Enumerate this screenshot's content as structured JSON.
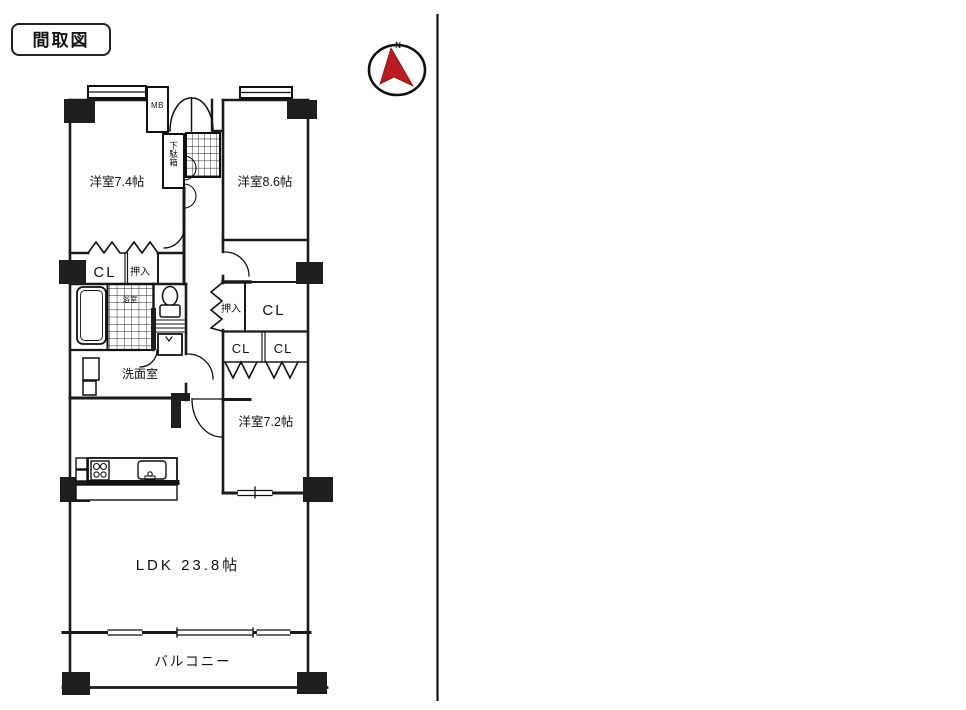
{
  "header": {
    "title": "間取図"
  },
  "compass": {
    "north_label": "N"
  },
  "colors": {
    "ink": "#1a1a1a",
    "compass_red": "#b81c20",
    "paper": "#ffffff"
  },
  "floorplan": {
    "rooms": {
      "bedroom_74": "洋室7.4帖",
      "bedroom_86": "洋室8.6帖",
      "bedroom_72": "洋室7.2帖",
      "ldk": "LDK 23.8帖",
      "balcony": "バルコニー",
      "washroom": "洗面室",
      "bath": "浴室"
    },
    "storage": {
      "closet_nw": "CL",
      "oshiire_nw": "押入",
      "oshiire_e": "押入",
      "closet_e": "CL",
      "closet_s1": "CL",
      "closet_s2": "CL",
      "shoe_cabinet": "下駄箱",
      "meter_box": "MB"
    }
  }
}
